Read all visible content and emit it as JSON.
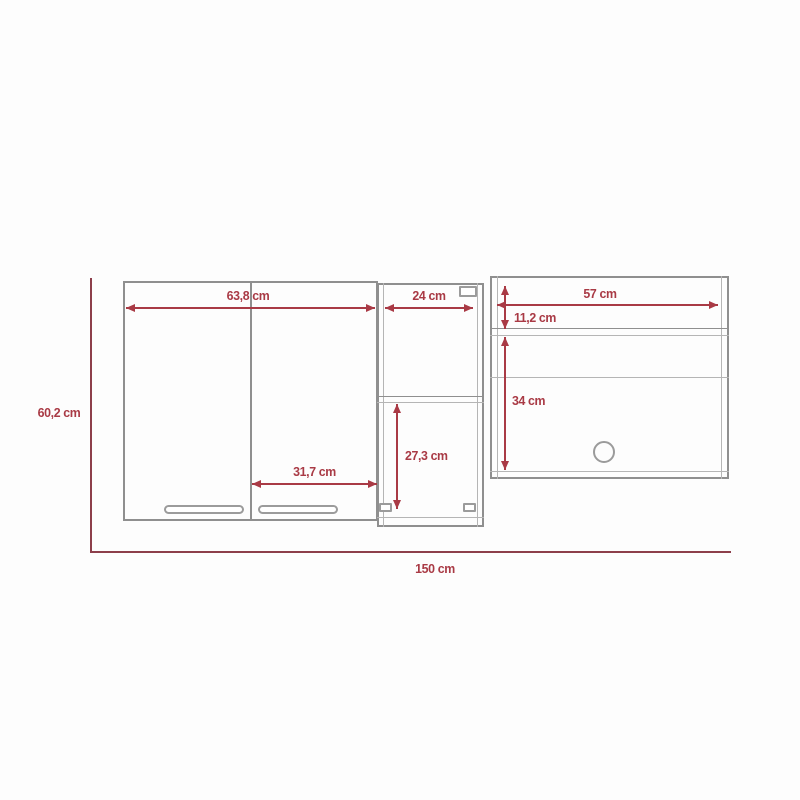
{
  "drawing": {
    "kind": "cabinet-dimension-diagram",
    "unit": "cm",
    "colors": {
      "background": "#fdfdfd",
      "cabinet_outline": "#8f8f8f",
      "dimension_red": "#a93a45",
      "overall_outline_red": "#8d3f4b"
    }
  },
  "labels": {
    "total_width": "150 cm",
    "total_height": "60,2 cm",
    "left_section_width": "63,8 cm",
    "left_door_width": "31,7 cm",
    "middle_section_width": "24 cm",
    "middle_opening_height": "27,3 cm",
    "right_section_width": "57 cm",
    "right_top_opening_height": "11,2 cm",
    "right_main_opening_height": "34 cm"
  }
}
